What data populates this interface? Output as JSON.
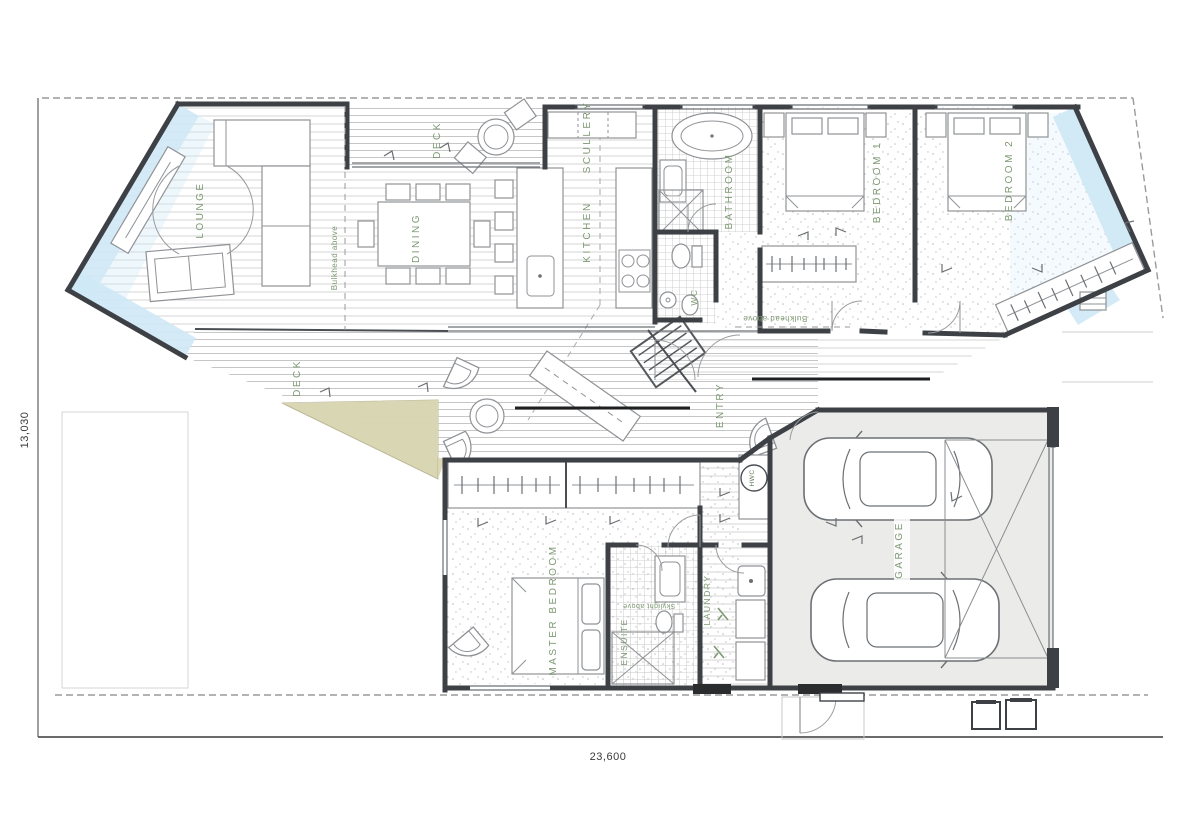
{
  "title": "Residential floor plan",
  "colors": {
    "wall": "#3d4146",
    "label_green": "#7d9872",
    "glazing_blue": "#cfe9f6",
    "garden_beige": "#d9d6b4",
    "garage_floor": "#ebebe9",
    "deck_line": "#c9cccd",
    "boundary": "#9a9a9a"
  },
  "rooms": {
    "lounge": {
      "label": "LOUNGE"
    },
    "deck_top": {
      "label": "DECK"
    },
    "dining": {
      "label": "DINING"
    },
    "scullery": {
      "label": "SCULLERY"
    },
    "kitchen": {
      "label": "KITCHEN"
    },
    "bathroom": {
      "label": "BATHROOM"
    },
    "wc": {
      "label": "WC"
    },
    "bedroom1": {
      "label": "BEDROOM 1"
    },
    "bedroom2": {
      "label": "BEDROOM 2"
    },
    "entry": {
      "label": "ENTRY"
    },
    "deck_middle": {
      "label": "DECK"
    },
    "master_bedroom": {
      "label": "MASTER BEDROOM"
    },
    "ensuite": {
      "label": "ENSUITE"
    },
    "laundry": {
      "label": "LAUNDRY"
    },
    "hwc": {
      "label": "HWC"
    },
    "garage": {
      "label": "GARAGE"
    }
  },
  "annotations": {
    "bulkhead_living": {
      "text": "Bulkhead above"
    },
    "bulkhead_hall": {
      "text": "Bulkhead above"
    },
    "skylight_ensuite": {
      "text": "Skylight above"
    }
  },
  "dimensions": {
    "site_width": "23,600",
    "site_depth": "13,030"
  }
}
